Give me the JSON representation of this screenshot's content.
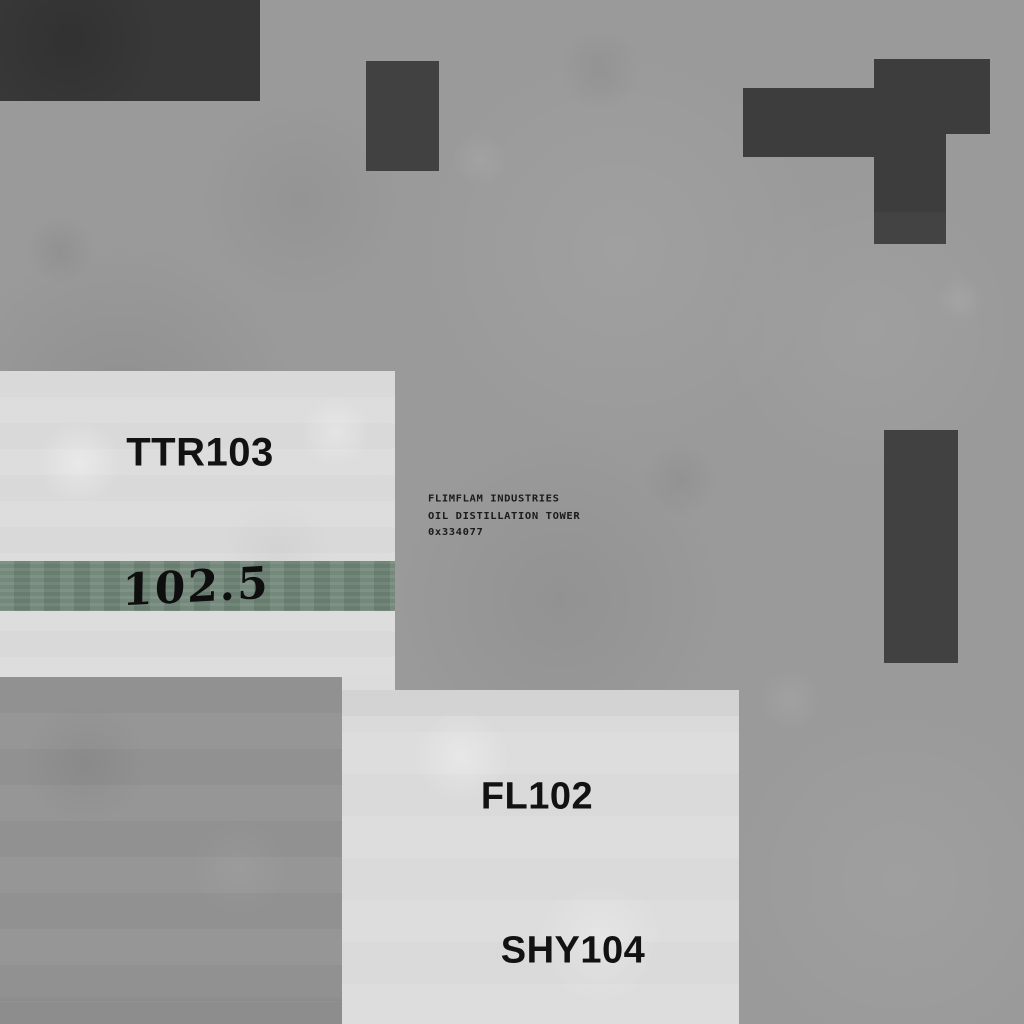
{
  "scene": {
    "description": "Top-down industrial facility ground texture with labeled storage tanks",
    "colors": {
      "background_concrete": "#9a9a9a",
      "light_panel": "#dcdcdc",
      "dark_block": "#3d3d3d",
      "level_band_green": "#6f8577",
      "lower_slab": "#949494",
      "label_text": "#121212"
    }
  },
  "tanks": {
    "ttr103_label": "TTR103",
    "fl102_label": "FL102",
    "shy104_label": "SHY104"
  },
  "gauge": {
    "value": "102.5"
  },
  "sign": {
    "line1": "FLIMFLAM INDUSTRIES",
    "line2": "OIL DISTILLATION TOWER",
    "line3": "0x334077"
  }
}
